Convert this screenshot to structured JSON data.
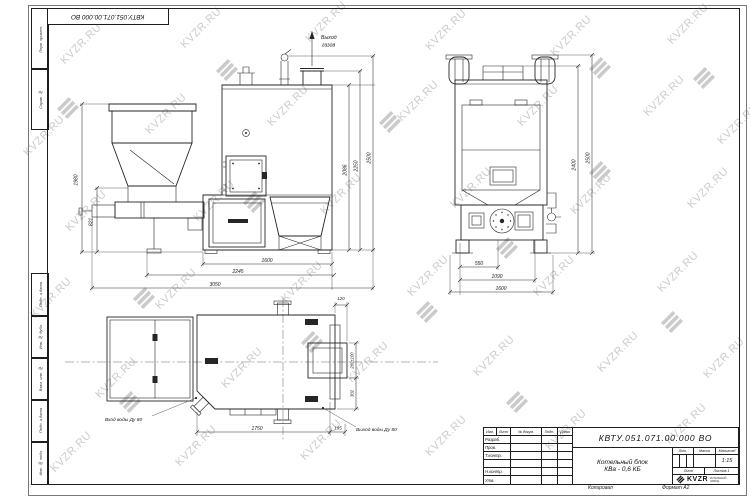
{
  "watermark": {
    "text": "KVZR.RU"
  },
  "frame": {
    "top_doc_number": "КВТУ.051.071.00.000 ВО",
    "copied_label": "Копировал",
    "format_label": "Формат А2",
    "side_stamps_top": [
      "Перв. примен.",
      "Справ. №"
    ],
    "side_stamps_bottom": [
      "Инв. № подл.",
      "Подп. и дата",
      "Взам. инв. №",
      "Инв. № дубл.",
      "Подп. и дата"
    ]
  },
  "views": {
    "side": {
      "gas_outlet_line1": "Выход",
      "gas_outlet_line2": "газов",
      "dim_bottom_1": "1600",
      "dim_bottom_2": "2245",
      "dim_bottom_3": "3050",
      "dim_right_1": "2086",
      "dim_right_2": "2250",
      "dim_right_3": "2500",
      "dim_left_1": "1980",
      "dim_left_2": "821"
    },
    "front": {
      "dim_bottom_1": "550",
      "dim_bottom_2": "1090",
      "dim_bottom_3": "1600",
      "dim_right_1": "2400",
      "dim_right_2": "2500"
    },
    "plan": {
      "water_inlet_label": "Вход воды Ду 80",
      "water_outlet_label": "Выход воды Ду 80",
      "dim_bottom_1": "1750",
      "dim_bottom_2": "195",
      "dim_top_right": "120",
      "dim_right_1": "200±100",
      "dim_right_2": "302"
    }
  },
  "title_block": {
    "doc_number": "КВТУ.051.071.00.000 ВО",
    "product_name_line1": "Котельный блок",
    "product_name_line2": "КВа - 0,6 КБ",
    "header_cols": [
      "Изм.",
      "Лист",
      "№ докум.",
      "Подп.",
      "Дата"
    ],
    "row_labels": [
      "Разраб.",
      "Пров.",
      "Т.контр.",
      "",
      "Н.контр.",
      "Утв."
    ],
    "lit_label": "Лит.",
    "mass_label": "Масса",
    "scale_label": "Масштаб",
    "scale_value": "1:15",
    "sheet_label": "Лист",
    "sheets_label": "Листов",
    "sheets_value": "1",
    "logo_text": "KVZR",
    "logo_sub1": "КОТЕЛЬНЫЙ",
    "logo_sub2": "ЗАВОД"
  }
}
